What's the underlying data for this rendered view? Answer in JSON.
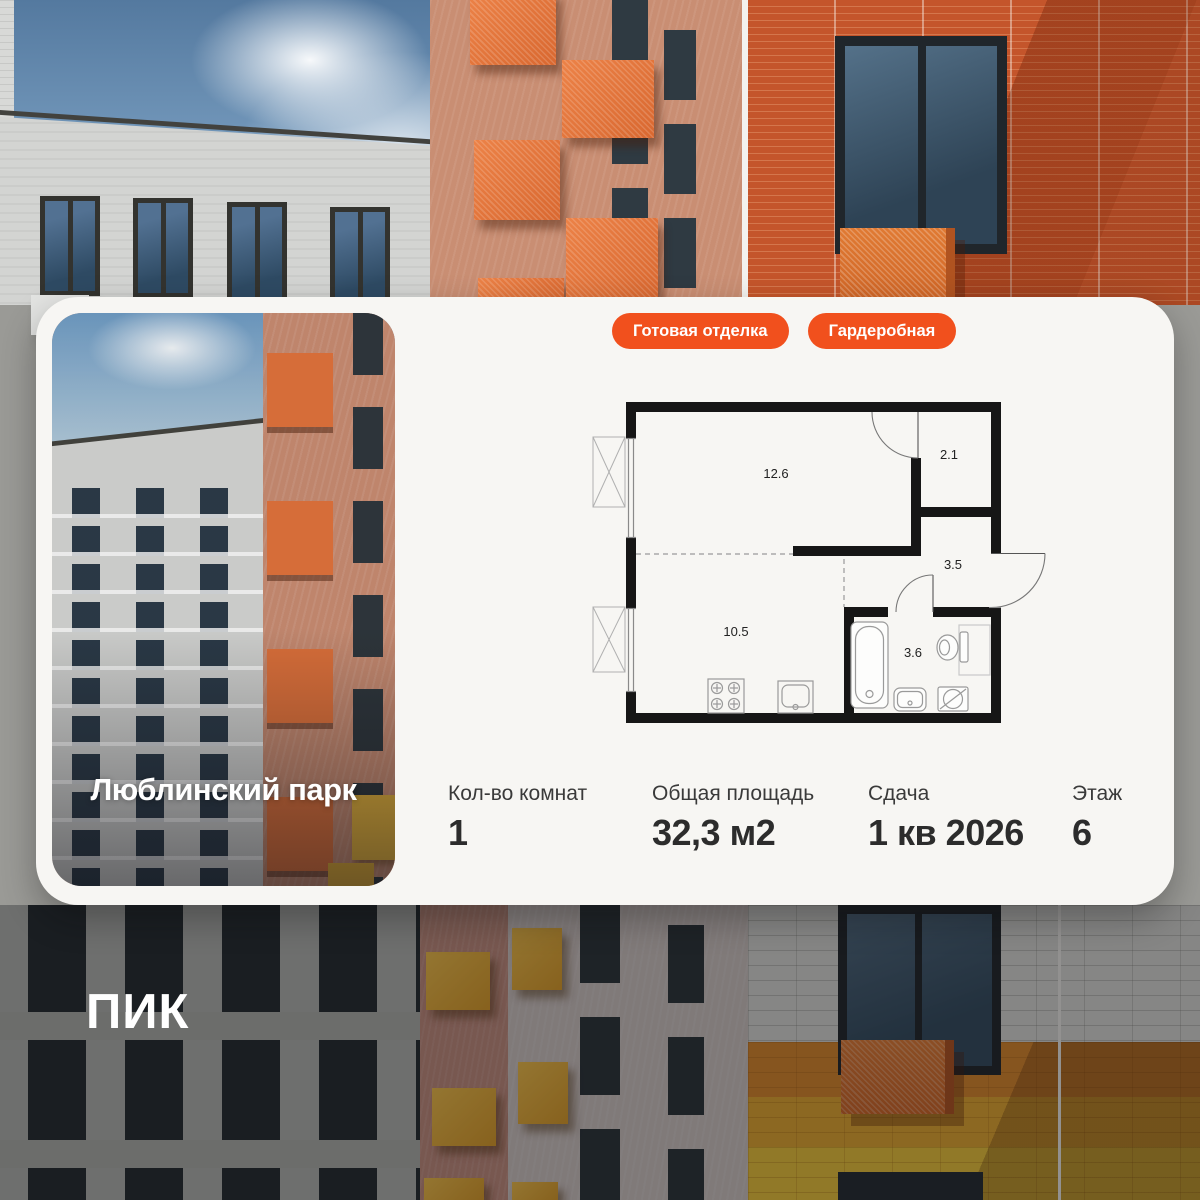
{
  "brand": {
    "logo_text": "ПИК"
  },
  "card": {
    "project_name": "Люблинский парк",
    "badges": [
      {
        "label": "Готовая отделка"
      },
      {
        "label": "Гардеробная"
      }
    ],
    "floor_plan": {
      "rooms": [
        {
          "name": "living-room",
          "area": "12.6"
        },
        {
          "name": "wardrobe",
          "area": "2.1"
        },
        {
          "name": "hallway",
          "area": "3.5"
        },
        {
          "name": "kitchen",
          "area": "10.5"
        },
        {
          "name": "bathroom",
          "area": "3.6"
        }
      ]
    },
    "stats": [
      {
        "label": "Кол-во комнат",
        "value": "1"
      },
      {
        "label": "Общая площадь",
        "value": "32,3 м2"
      },
      {
        "label": "Сдача",
        "value": "1 кв 2026"
      },
      {
        "label": "Этаж",
        "value": "6"
      }
    ]
  },
  "colors": {
    "accent": "#F1501D",
    "card_bg": "#F7F6F3"
  }
}
